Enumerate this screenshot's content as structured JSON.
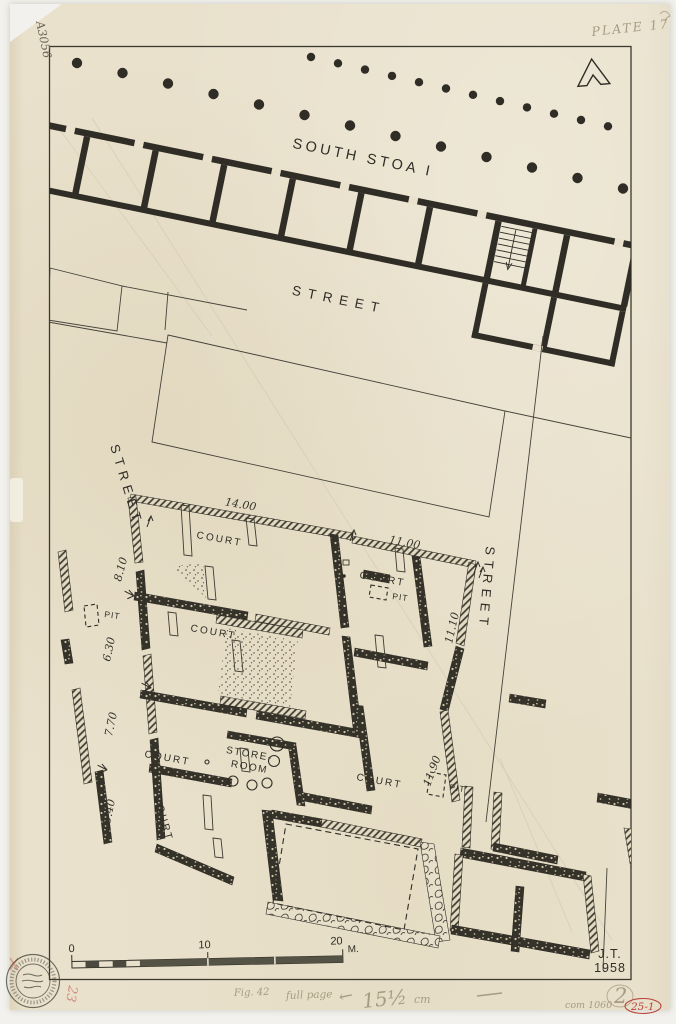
{
  "plate_title": "Plan of South Stoa I and adjacent house blocks",
  "labels": {
    "south_stoa": "SOUTH STOA I",
    "street": "STREET",
    "court": "COURT",
    "pit": "PIT",
    "store_room_1": "STORE-",
    "store_room_2": "ROOM"
  },
  "dims": {
    "w14": "14.00",
    "w11": "11.00",
    "l810": "8.10",
    "l630": "6.30",
    "l770": "7.70",
    "l540": "5.40",
    "r1110": "11.10",
    "r1190": "11.90"
  },
  "scale": {
    "t0": "0",
    "t10": "10",
    "t20": "20",
    "unit": "M."
  },
  "sig": {
    "initials": "J.T.",
    "year": "1958"
  },
  "notes": {
    "catalog": "A3056",
    "plate": "PLATE 17",
    "fig": "Fig. 42",
    "fig2": "full page",
    "arrow": "←",
    "size": "15½",
    "unit": "cm",
    "two": "2",
    "code": "com 1060",
    "red_code": "25-1",
    "red_stamp": "23"
  },
  "colors": {
    "paper": "#e9e1cc",
    "ink": "#2f2d26",
    "wall_dark": "#35322a",
    "pencil": "#a79c82",
    "red": "#b9423a"
  }
}
